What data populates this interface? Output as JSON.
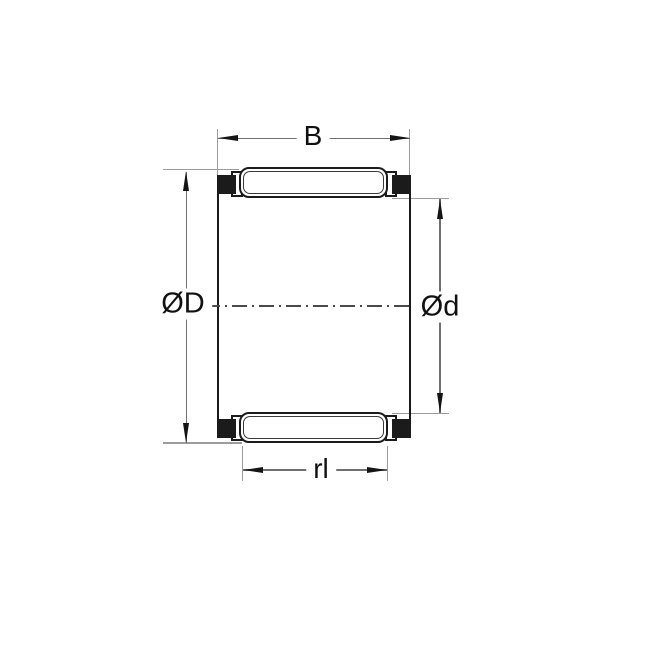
{
  "diagram": {
    "title": "bearing-cross-section",
    "labels": {
      "width": "B",
      "outer_diameter": "ØD",
      "inner_diameter": "Ød",
      "roller_length": "rl"
    },
    "colors": {
      "background": "#ffffff",
      "drawing_line": "#1b1b1b",
      "dimension_line": "#707070",
      "extension_line": "#9c9c9c",
      "cage_block_fill": "#1b1b1b",
      "text": "#111111"
    }
  }
}
